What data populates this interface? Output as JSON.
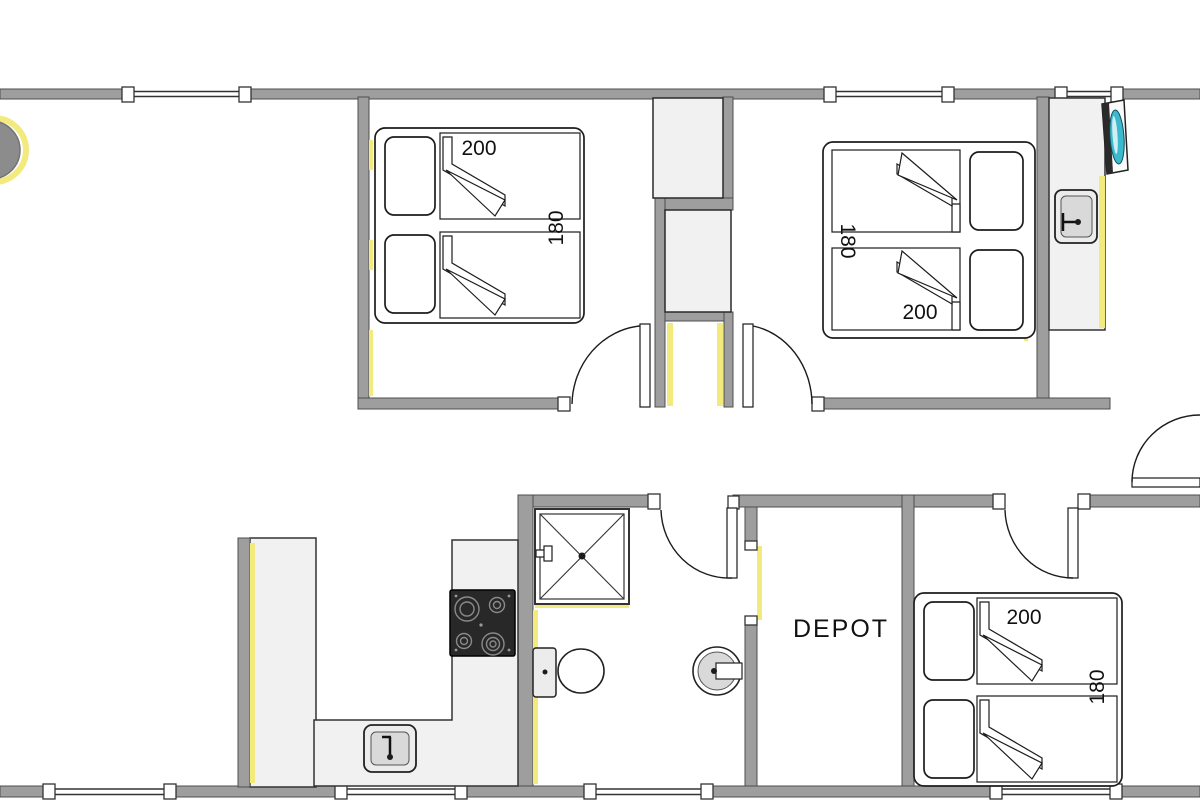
{
  "plan": {
    "type": "floor-plan",
    "rooms": {
      "bedroom_top_left": {
        "bed_width": "200",
        "bed_length": "180"
      },
      "bedroom_top_right": {
        "bed_width": "200",
        "bed_length": "180"
      },
      "bedroom_bottom_right": {
        "bed_width": "200",
        "bed_length": "180"
      },
      "depot": {
        "label": "DEPOT"
      }
    },
    "colors": {
      "wall": "#9e9e9e",
      "wall_outline": "#4d4d4d",
      "fixture_fill": "#f1f1f1",
      "accent_yellow": "#f2ea7d",
      "washer_teal": "#3cb9cc",
      "cooktop_black": "#282828",
      "text": "#111111",
      "background": "#ffffff"
    }
  }
}
